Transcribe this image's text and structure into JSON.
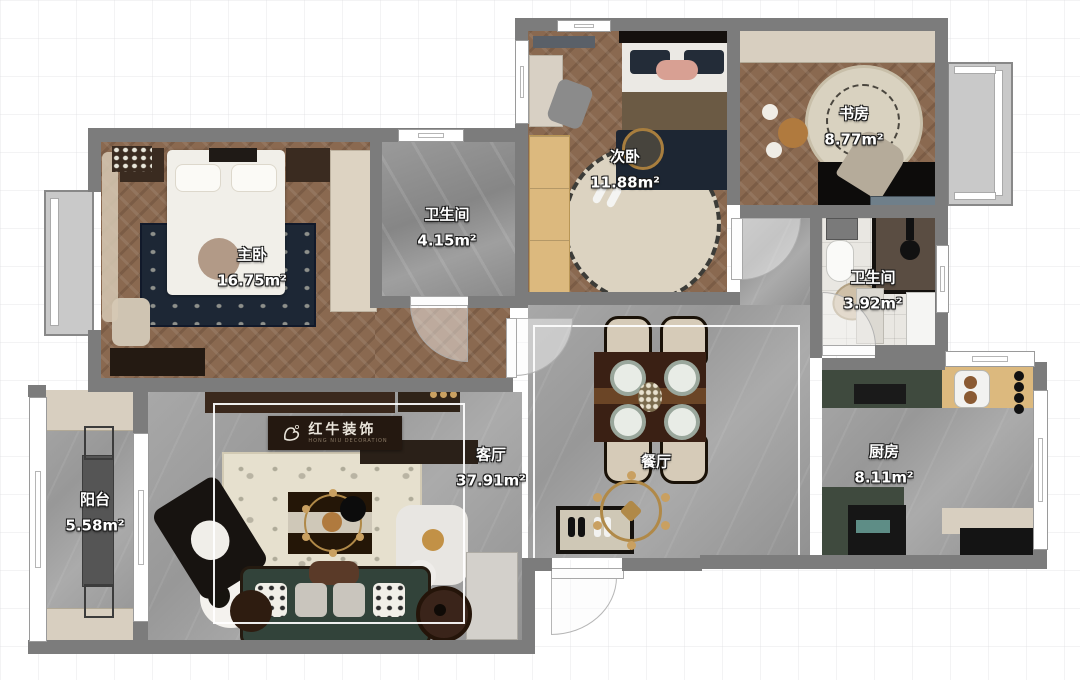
{
  "rooms": {
    "master": {
      "label": "主卧",
      "area": "16.75m²"
    },
    "bath1": {
      "label": "卫生间",
      "area": "4.15m²"
    },
    "second": {
      "label": "次卧",
      "area": "11.88m²"
    },
    "study": {
      "label": "书房",
      "area": "8.77m²"
    },
    "bath2": {
      "label": "卫生间",
      "area": "3.92m²"
    },
    "dining": {
      "label": "餐厅"
    },
    "kitchen": {
      "label": "厨房",
      "area": "8.11m²"
    },
    "living": {
      "label": "客厅",
      "area": "37.91m²"
    },
    "balcony": {
      "label": "阳台",
      "area": "5.58m²"
    }
  },
  "logo": {
    "brand": "红牛装饰",
    "subtitle": "HONG NIU DECORATION"
  },
  "colors": {
    "wall": "#7c7c7c",
    "wood_floor": "#8a6950",
    "gray_tile": "#9c9c9c",
    "accent_gold": "#b08948",
    "sofa_green": "#35463c",
    "counter_green": "#3f4a3e",
    "rug_navy": "#1d2735",
    "cabinet_beige": "#d8cfc0",
    "light_wood": "#dcb97e"
  }
}
